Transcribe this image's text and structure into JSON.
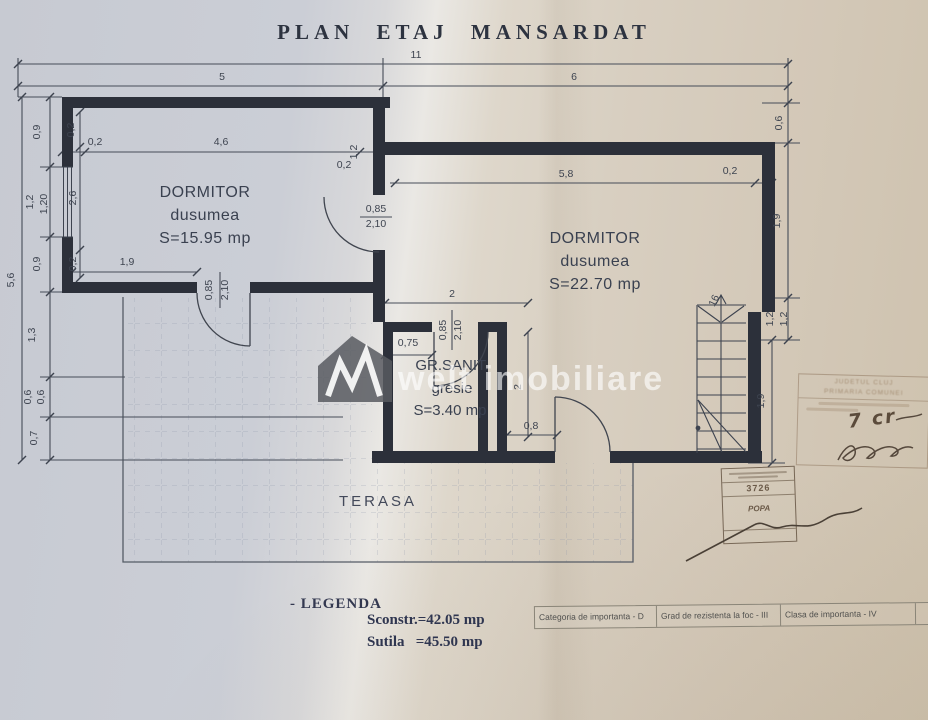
{
  "title": "PLAN ETAJ MANSARDAT",
  "watermark": {
    "text": "welt imobiliare"
  },
  "rooms": [
    {
      "name": "DORMITOR",
      "finish": "dusumea",
      "area": "S=15.95 mp"
    },
    {
      "name": "DORMITOR",
      "finish": "dusumea",
      "area": "S=22.70 mp"
    },
    {
      "name": "GR.SANIT.",
      "finish": "gresie",
      "area": "S=3.40 mp"
    },
    {
      "name": "TERASA"
    }
  ],
  "dimensions": [
    {
      "text": "11",
      "x": 416,
      "y": 58
    },
    {
      "text": "5",
      "x": 222,
      "y": 80
    },
    {
      "text": "6",
      "x": 574,
      "y": 80
    },
    {
      "text": "5,6",
      "x": 14,
      "y": 280,
      "rot": -90
    },
    {
      "text": "0,9",
      "x": 40,
      "y": 132,
      "rot": -90
    },
    {
      "text": "1,2",
      "x": 33,
      "y": 202,
      "rot": -90
    },
    {
      "text": "1,20",
      "x": 47,
      "y": 204,
      "rot": -90
    },
    {
      "text": "0,9",
      "x": 40,
      "y": 264,
      "rot": -90
    },
    {
      "text": "1,3",
      "x": 35,
      "y": 335,
      "rot": -90
    },
    {
      "text": "0,6",
      "x": 31,
      "y": 397,
      "rot": -90
    },
    {
      "text": "0,6",
      "x": 44,
      "y": 397,
      "rot": -90
    },
    {
      "text": "0,7",
      "x": 37,
      "y": 438,
      "rot": -90
    },
    {
      "text": "0,2",
      "x": 74,
      "y": 130,
      "rot": -90
    },
    {
      "text": "2,6",
      "x": 76,
      "y": 198,
      "rot": -90
    },
    {
      "text": "0,2",
      "x": 76,
      "y": 264,
      "rot": -90
    },
    {
      "text": "0,2",
      "x": 95,
      "y": 145
    },
    {
      "text": "4,6",
      "x": 221,
      "y": 145
    },
    {
      "text": "0,2",
      "x": 344,
      "y": 168
    },
    {
      "text": "1,2",
      "x": 357,
      "y": 152,
      "rot": -90
    },
    {
      "text": "5,8",
      "x": 566,
      "y": 177
    },
    {
      "text": "0,2",
      "x": 730,
      "y": 174
    },
    {
      "text": "0,6",
      "x": 782,
      "y": 123,
      "rot": -90
    },
    {
      "text": "1,9",
      "x": 780,
      "y": 221,
      "rot": -90
    },
    {
      "text": "1,2",
      "x": 773,
      "y": 319,
      "rot": -90
    },
    {
      "text": "1,2",
      "x": 787,
      "y": 319,
      "rot": -90
    },
    {
      "text": "1,9",
      "x": 764,
      "y": 401,
      "rot": -90
    },
    {
      "text": "1,9",
      "x": 127,
      "y": 265
    },
    {
      "text": "0,85",
      "x": 376,
      "y": 212
    },
    {
      "text": "2,10",
      "x": 376,
      "y": 227
    },
    {
      "text": "0,85",
      "x": 212,
      "y": 290,
      "rot": -90
    },
    {
      "text": "2,10",
      "x": 228,
      "y": 290,
      "rot": -90
    },
    {
      "text": "2",
      "x": 452,
      "y": 297
    },
    {
      "text": "0,75",
      "x": 408,
      "y": 346
    },
    {
      "text": "0,85",
      "x": 446,
      "y": 330,
      "rot": -90
    },
    {
      "text": "2,10",
      "x": 461,
      "y": 330,
      "rot": -90
    },
    {
      "text": "2",
      "x": 521,
      "y": 387,
      "rot": -90
    },
    {
      "text": "0,8",
      "x": 531,
      "y": 429
    },
    {
      "text": "16",
      "x": 717,
      "y": 302,
      "rot": -65
    }
  ],
  "legend": {
    "heading": "- LEGENDA",
    "built_area": "Sconstr.=42.05 mp",
    "usable_area": "Sutila   =45.50 mp"
  },
  "info_table": {
    "cells": [
      "Categoria de importanta - D",
      "Grad de rezistenta la foc - III",
      "Clasa de importanta - IV"
    ]
  },
  "stamps": {
    "official": {
      "line1": "JUDETUL CLUJ",
      "line2": "PRIMARIA COMUNEI",
      "handwritten_note": "7 cr"
    },
    "architect": {
      "number": "3726",
      "name": "POPA"
    }
  }
}
